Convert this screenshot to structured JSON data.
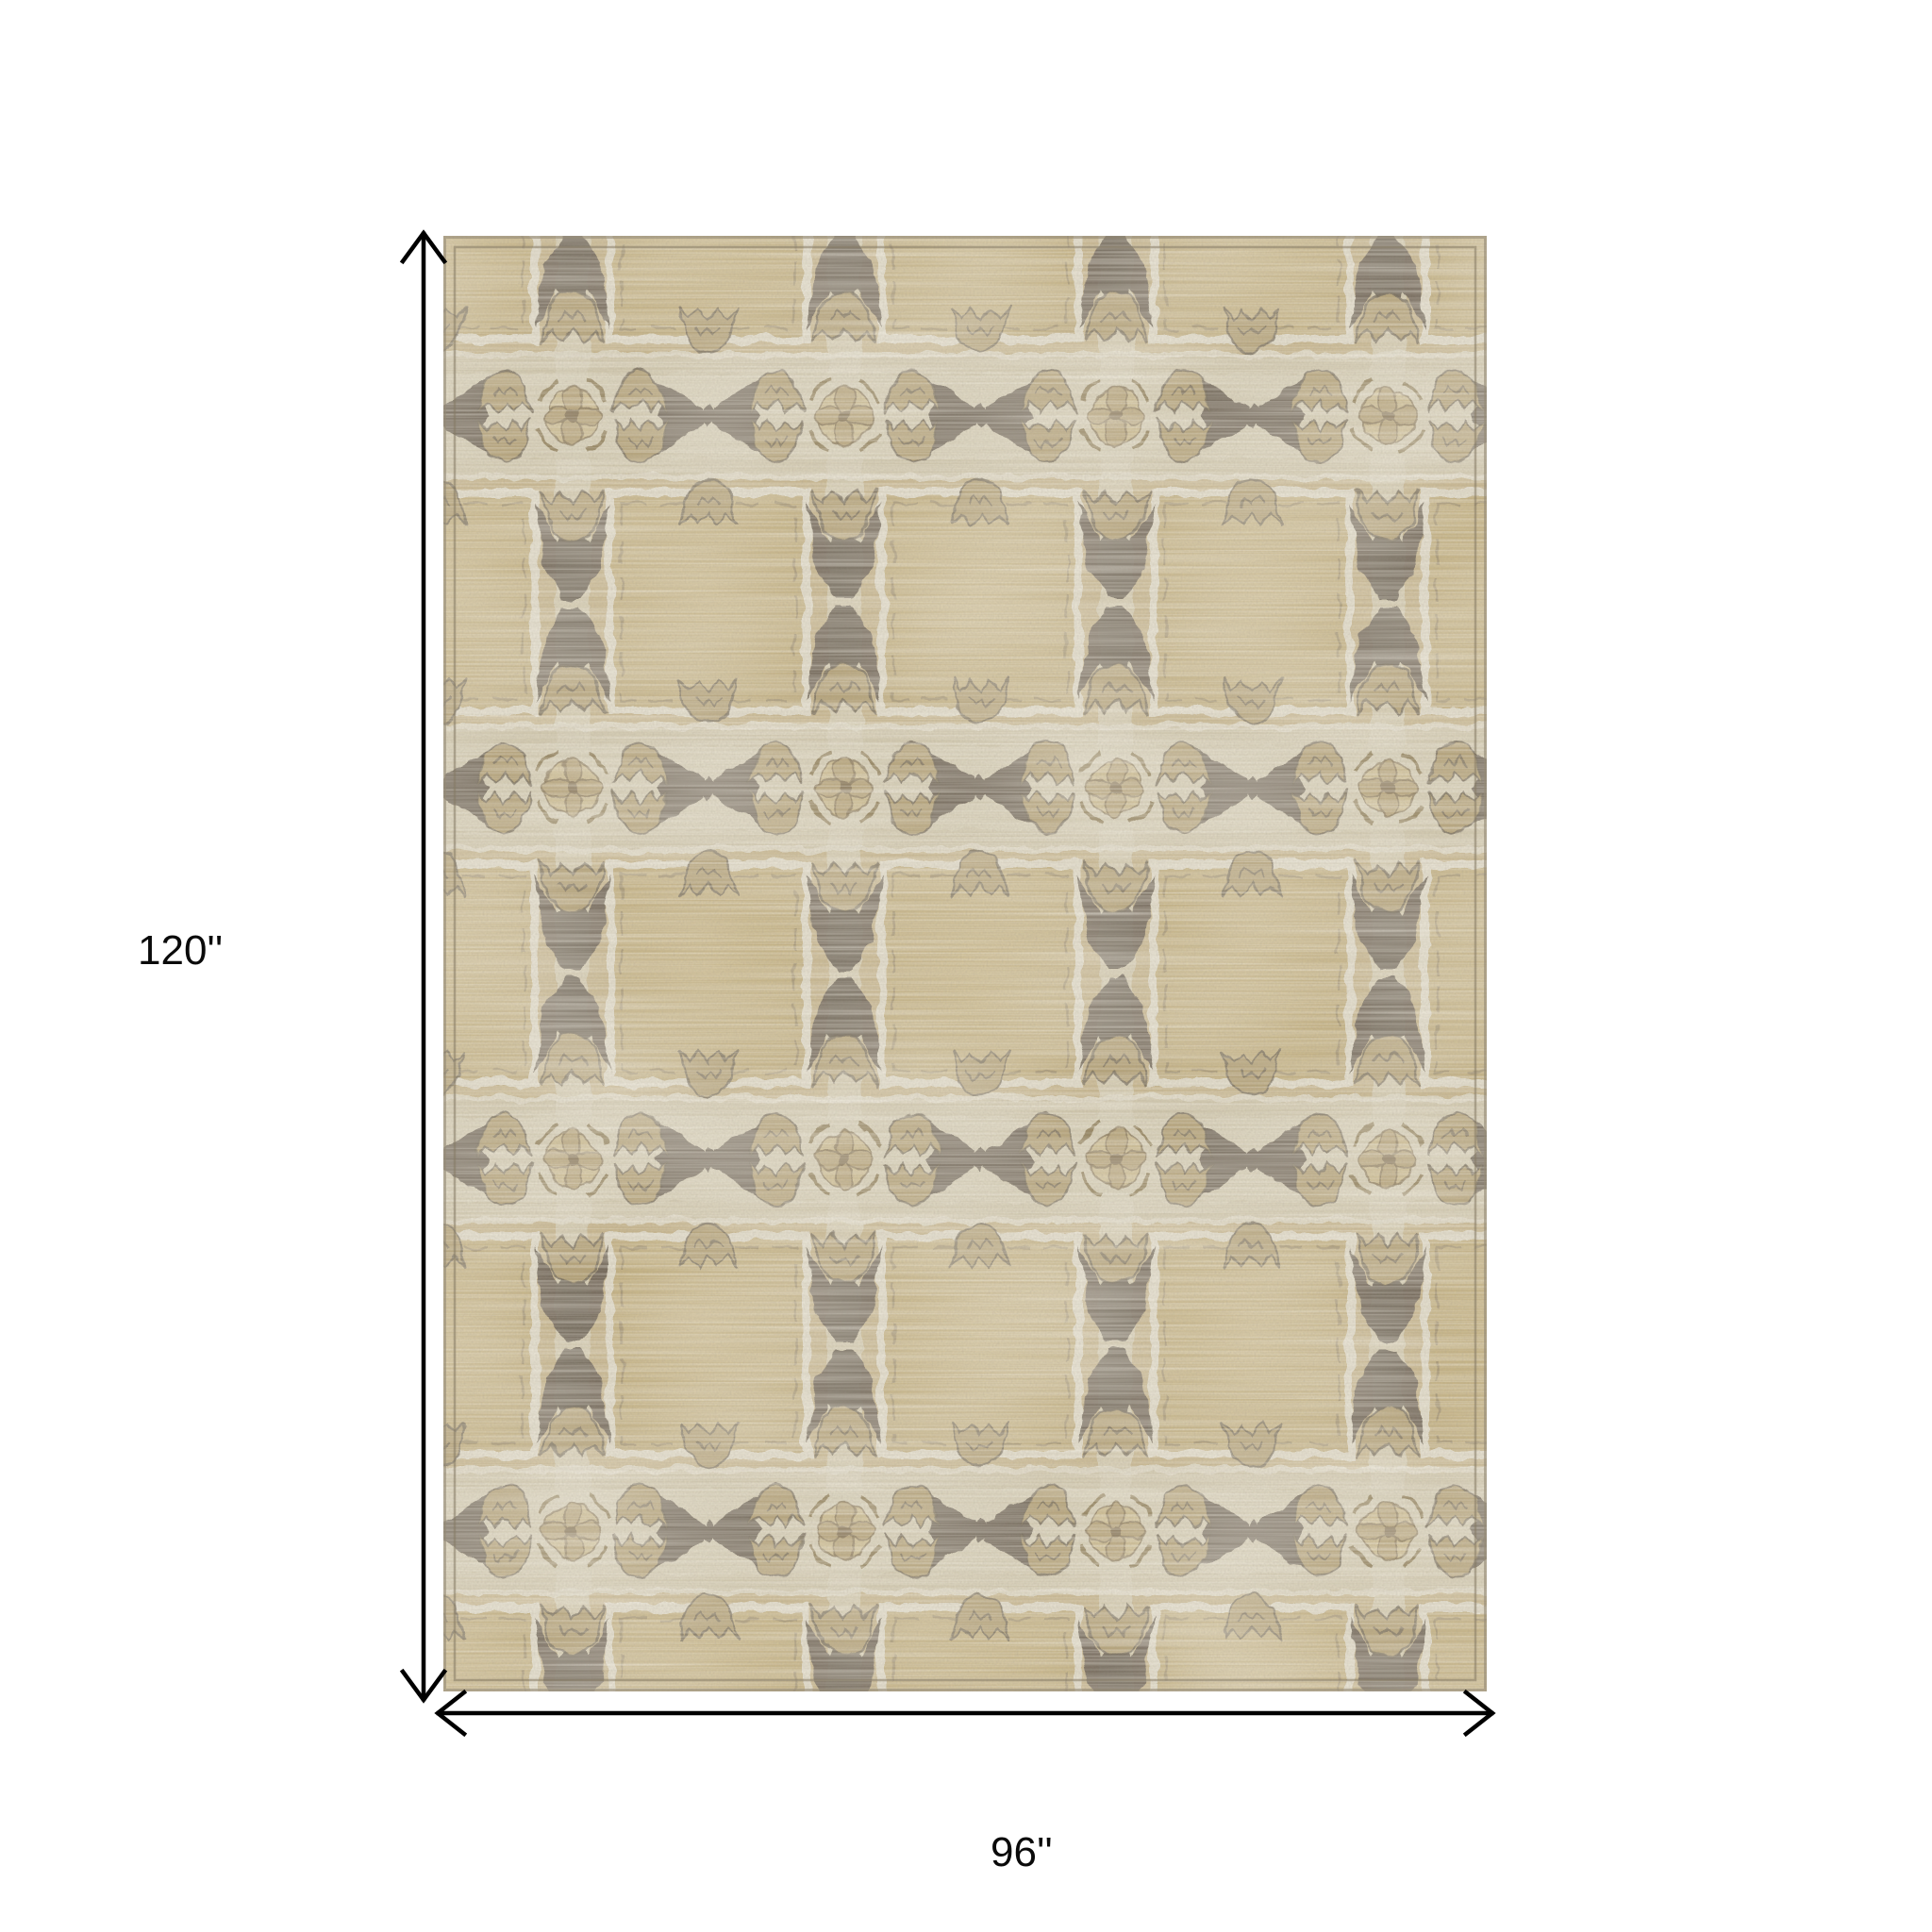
{
  "page": {
    "background_color": "#ffffff",
    "content": "Product dimensions diagram of a rectangular patterned area rug"
  },
  "dimensions": {
    "height_label": "120''",
    "width_label": "96''"
  },
  "rug": {
    "style": "distressed vintage lattice with hourglass columns, bowtie X motifs and quatrefoil medallions",
    "colors": {
      "base_tan": "#c4b38c",
      "panel_tan": "#c2b083",
      "band_beige": "#cec5ab",
      "light_cream": "#dcd6c4",
      "dark_taupe": "#6f6557",
      "medium_brown": "#b2a077",
      "outline_brown": "#8a795c",
      "edge_brown": "#948a76"
    }
  },
  "annotation": {
    "arrow_color": "#000000"
  }
}
